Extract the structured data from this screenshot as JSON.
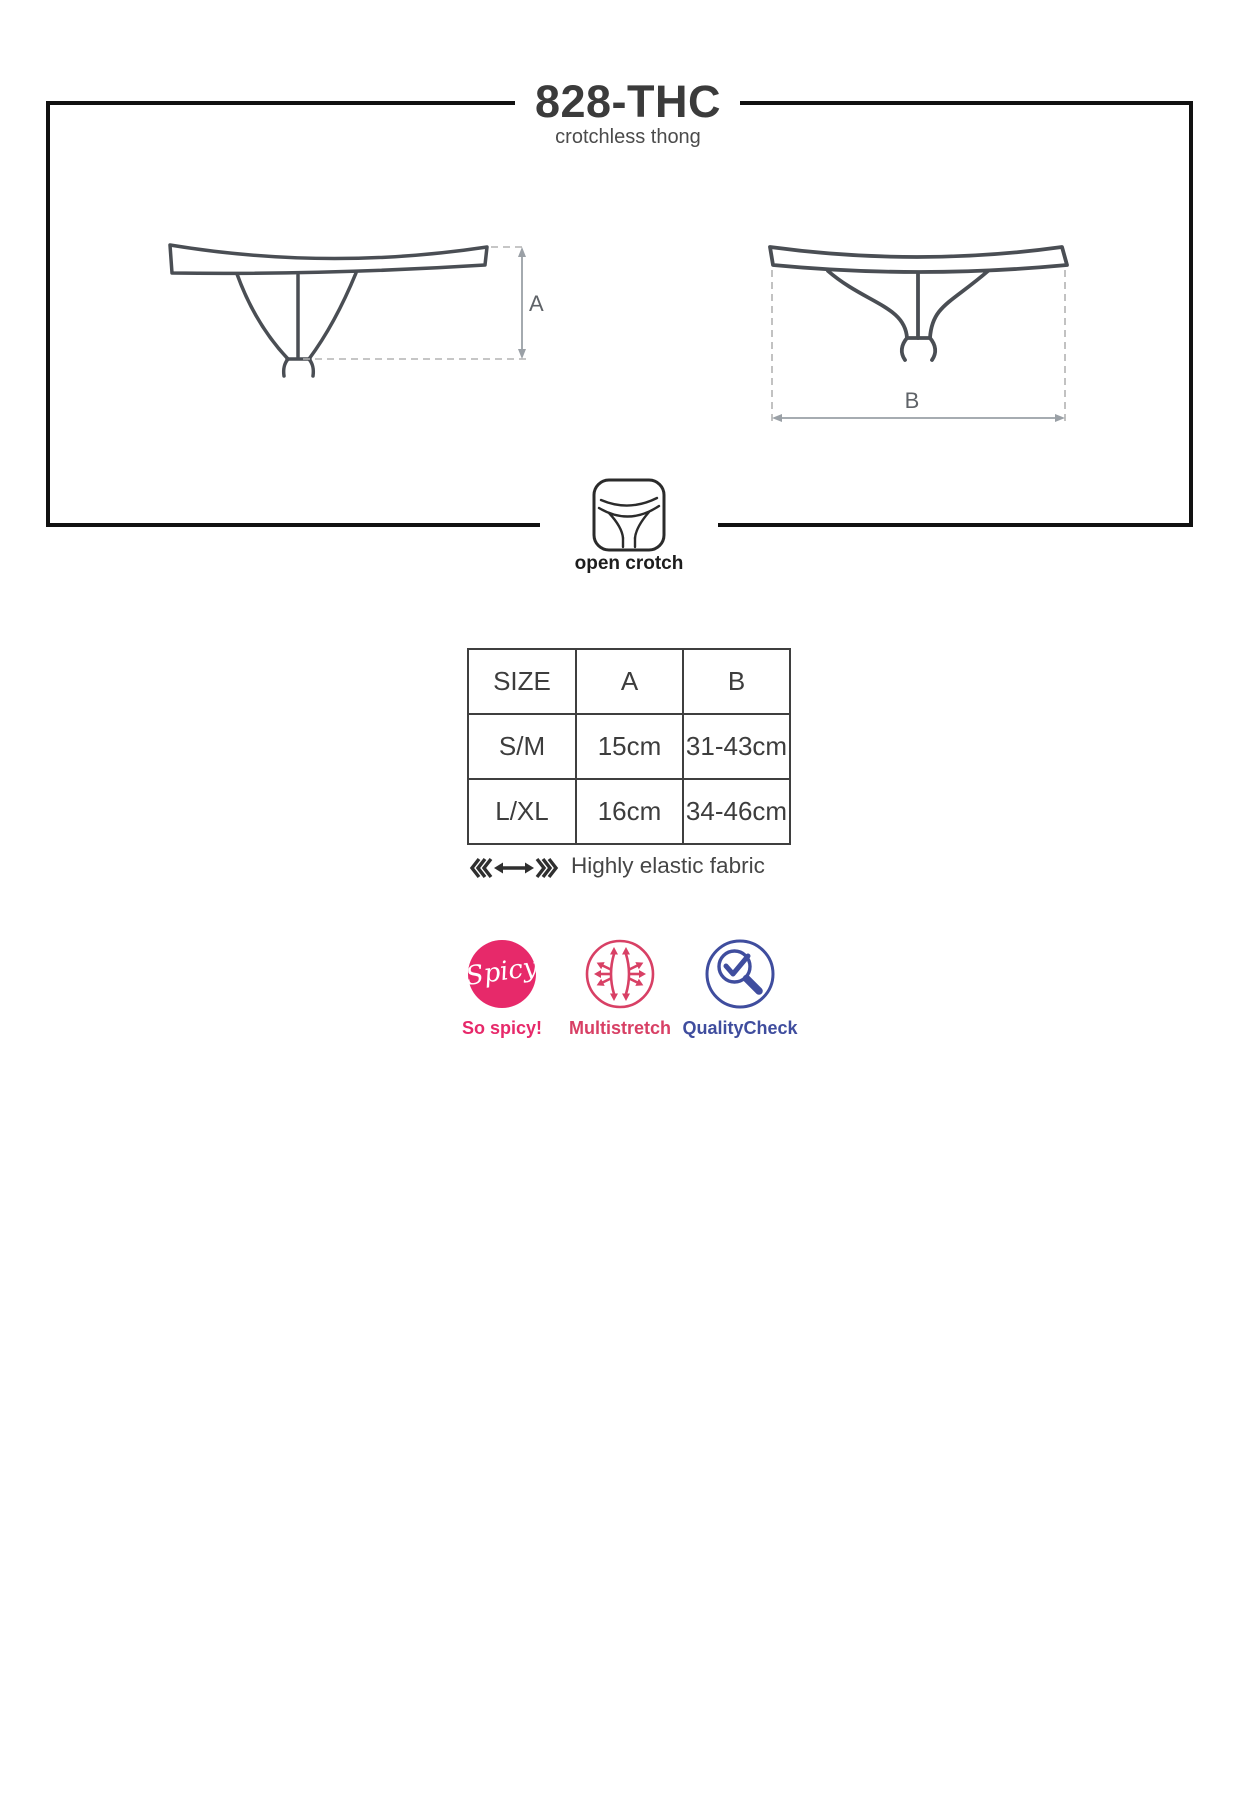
{
  "page": {
    "title": "828-THC",
    "subtitle": "crotchless thong"
  },
  "drawings": {
    "front": {
      "dimension_label": "A"
    },
    "back": {
      "dimension_label": "B"
    }
  },
  "open_crotch": {
    "label": "open crotch"
  },
  "size_table": {
    "headers": [
      "SIZE",
      "A",
      "B"
    ],
    "rows": [
      [
        "S/M",
        "15cm",
        "31-43cm"
      ],
      [
        "L/XL",
        "16cm",
        "34-46cm"
      ]
    ]
  },
  "elastic": {
    "label": "Highly elastic fabric"
  },
  "badges": [
    {
      "name": "spicy",
      "circle_text": "Spicy",
      "label": "So spicy!",
      "color": "#e7296a"
    },
    {
      "name": "multistretch",
      "label": "Multistretch",
      "color": "#d84065"
    },
    {
      "name": "qualitycheck",
      "label": "QualityCheck",
      "color": "#3f4d9e"
    }
  ],
  "colors": {
    "frame": "#111111",
    "garment_outline": "#4a4e54",
    "dimension_lines": "#9aa0a6"
  }
}
